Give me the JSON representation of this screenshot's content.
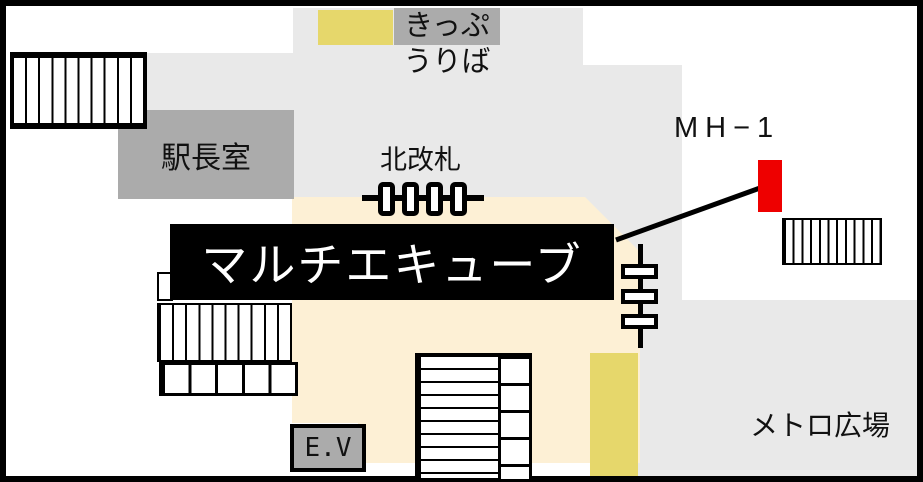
{
  "map": {
    "labels": {
      "ticket_office_line1": "きっぷ",
      "ticket_office_line2": "うりば",
      "station_master_office": "駅長室",
      "north_gate": "北改札",
      "manhole_id": "MH−1",
      "title_banner": "マルチエキューブ",
      "metro_plaza": "メトロ広場",
      "elevator": "E.V"
    },
    "colors": {
      "floor_gray": "#e9e9e9",
      "room_gray": "#ababab",
      "accent_yellow": "#e6d76b",
      "hall_beige": "#fdf0d5",
      "marker_red": "#ee0000",
      "line_black": "#000000",
      "banner_bg": "#000000",
      "banner_text": "#ffffff"
    }
  }
}
